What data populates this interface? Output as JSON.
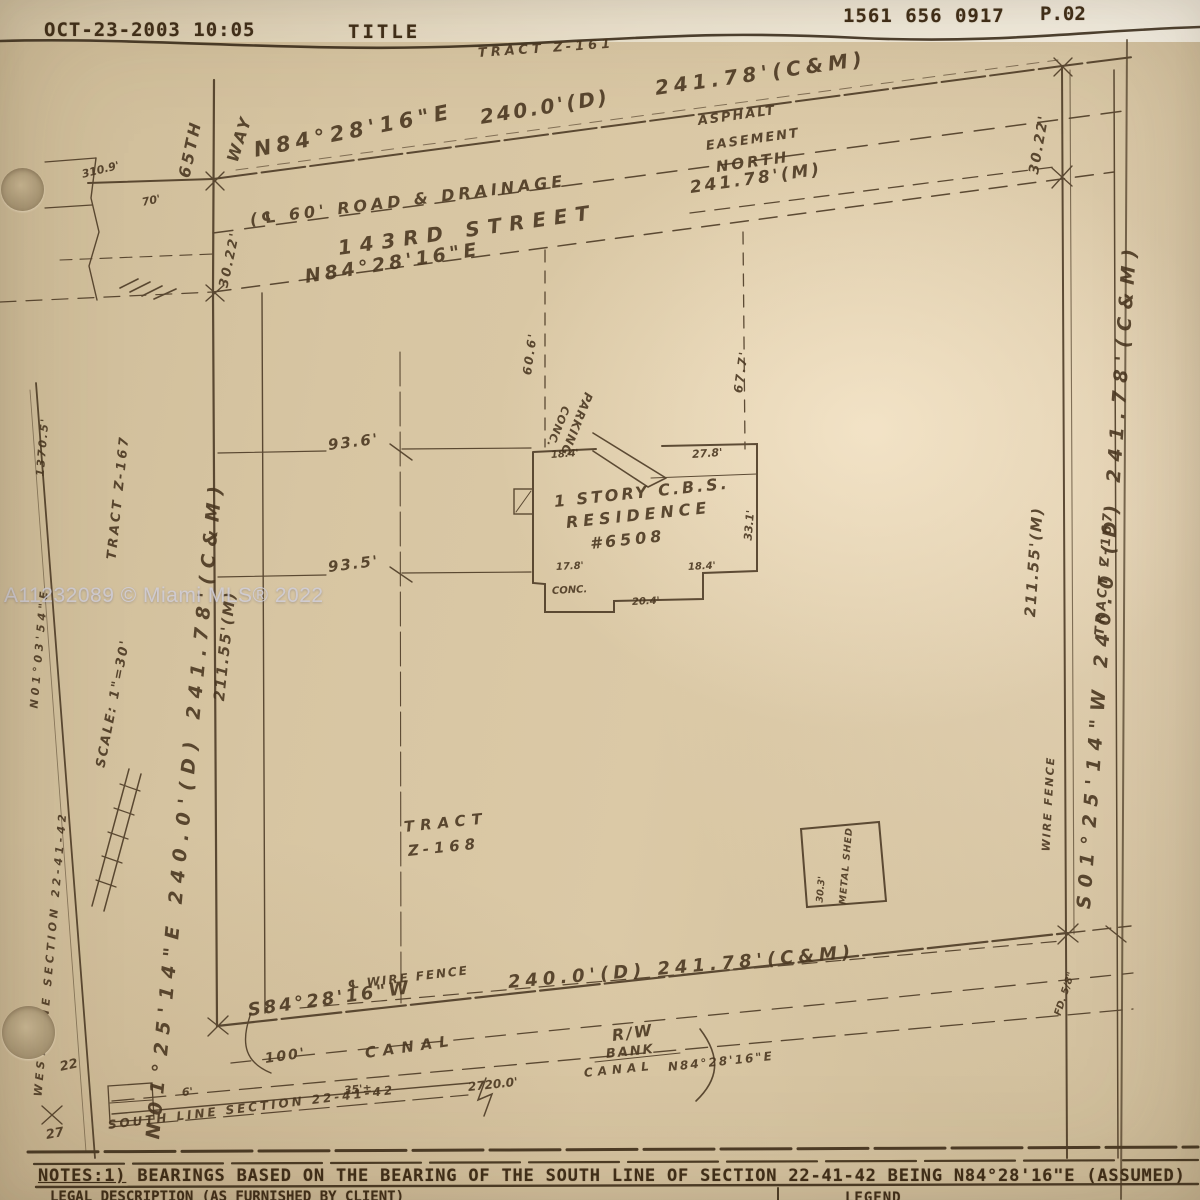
{
  "fax_header": {
    "datetime": "OCT-23-2003  10:05",
    "doc_title": "TITLE",
    "fax_number": "1561 656 0917",
    "page": "P.02"
  },
  "watermark": "A11232089 © Miami MLS® 2022",
  "survey": {
    "labels": {
      "tract_z161": "TRACT Z-161",
      "top_bearing": "N84°28'16\"E",
      "top_dist_d": "240.0'(D)",
      "top_dist_cm": "241.78'(C&M)",
      "street_easement": "(℄ 60' ROAD & DRAINAGE",
      "street_name": "143RD  STREET",
      "street_bearing": "N84°28'16\"E",
      "asphalt": "ASPHALT",
      "easement": "EASEMENT",
      "north_word": "NORTH",
      "dist_m": "241.78'(M)",
      "way": "WAY",
      "st_65th": "65TH",
      "dim_310_9": "310.9'",
      "dim_70": "70'",
      "w_30_22": "30.22'",
      "e_30_22": "30.22'",
      "w_211_55": "211.55'(M)",
      "e_211_55": "211.55'(M)",
      "dim_93_6": "93.6'",
      "dim_93_5": "93.5'",
      "dim_60_6": "60.6'",
      "dim_67_7": "67.7'",
      "conc": "CONC.",
      "parking": "PARKING",
      "res_line1": "1 STORY C.B.S.",
      "res_line2": "RESIDENCE",
      "res_line3": "#6508",
      "dim_27_8": "27.8'",
      "dim_18_4a": "18.4'",
      "dim_33_1": "33.1'",
      "dim_17_8": "17.8'",
      "dim_18_4b": "18.4'",
      "dim_20_4": "20.4'",
      "patio_conc": "CONC.",
      "tract_label": "TRACT",
      "tract_z168": "Z-168",
      "shed_dim": "30.3'",
      "shed_name": "METAL SHED",
      "e_long": "S01°25'14\"W  240.0'(D)  241.78'(C&M)",
      "tract_z167_e": "TRACT Z-167",
      "tract_z167_w": "TRACT Z-167",
      "wire_fence_e": "WIRE FENCE",
      "found_e": "FD. 5/8\"",
      "s_fence": "℄ WIRE FENCE",
      "s_bearing": "S84°28'16\"W",
      "s_dist": "240.0'(D)  241.78'(C&M)",
      "canal_100": "100'",
      "canal_word": "CANAL",
      "rw": "R/W",
      "bank": "BANK",
      "canal_word2": "CANAL",
      "canal_bearing": "N84°28'16\"E",
      "dim_2720": "2720.0'",
      "dim_35": "35'±",
      "dim_6": "6'",
      "south_line": "SOUTH LINE SECTION 22-41-42",
      "west_line": "WEST LINE SECTION 22-41-42",
      "w_bearing": "N01°03'54\"E",
      "w_1370": "1370.5'",
      "w_long": "N01°25'14\"E  240.0'(D)  241.78'(C&M)",
      "scale": "SCALE: 1\"=30'",
      "corner_22": "22",
      "corner_27": "27"
    }
  },
  "notes": {
    "label": "NOTES:1)",
    "text": "  BEARINGS BASED ON THE BEARING OF THE SOUTH LINE OF SECTION 22-41-42 BEING N84°28'16\"E (ASSUMED)"
  },
  "footer": {
    "legal_description": "LEGAL DESCRIPTION (AS FURNISHED BY CLIENT)",
    "legend": "LEGEND"
  }
}
